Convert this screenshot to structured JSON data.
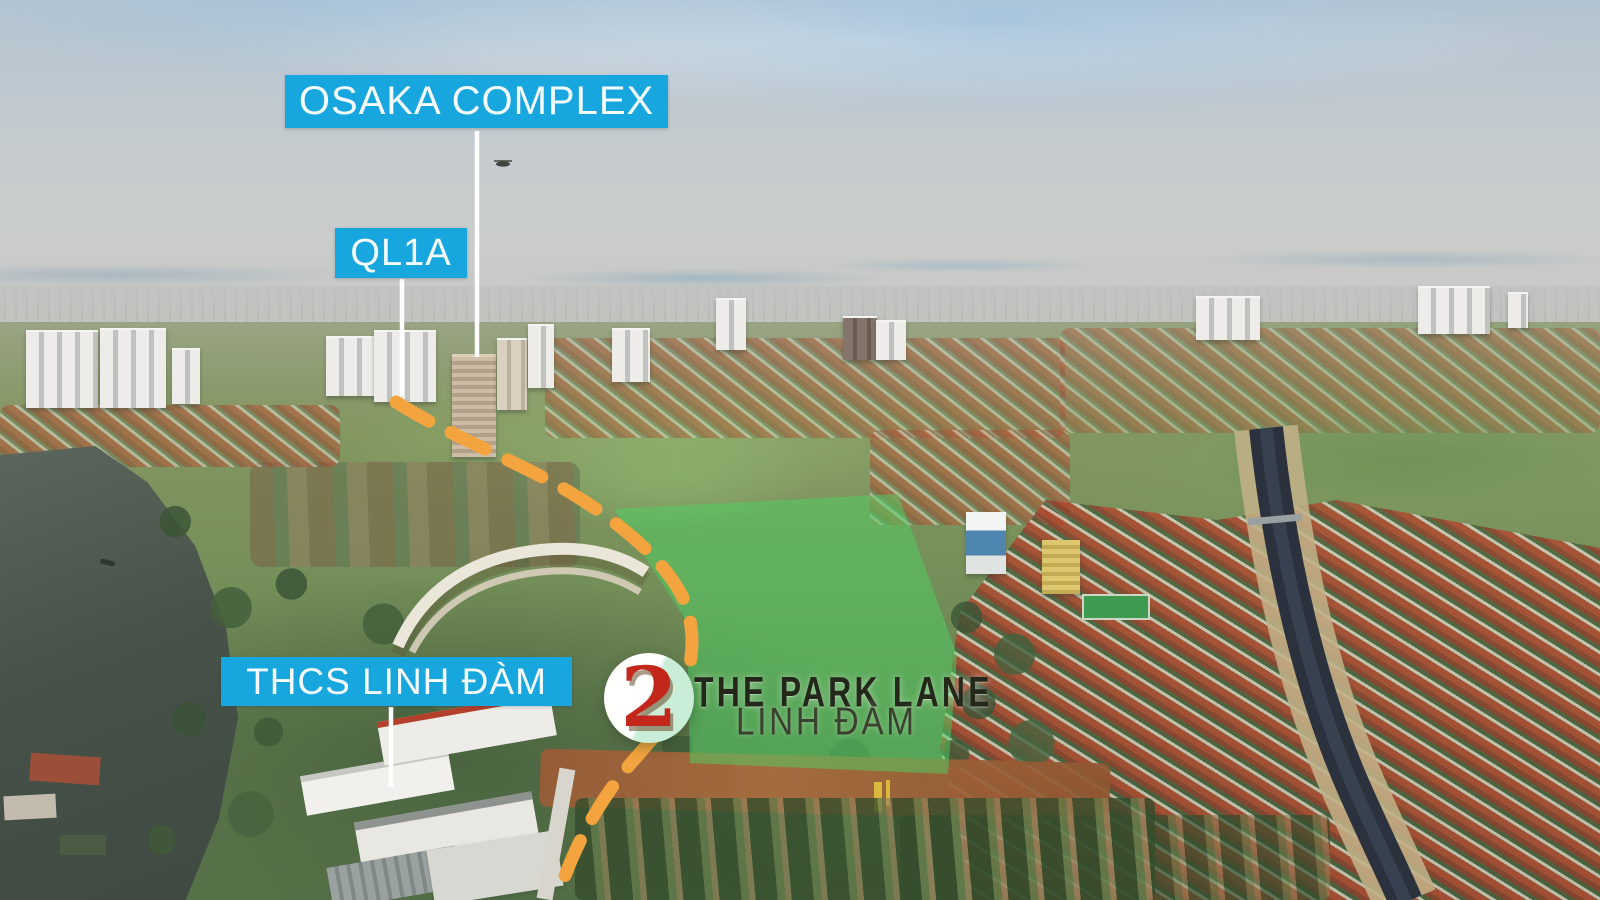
{
  "labels": {
    "osaka_complex": "OSAKA COMPLEX",
    "ql1a": "QL1A",
    "thcs_linh_dam": "THCS LINH ĐÀM"
  },
  "project": {
    "marker_number": "2",
    "name": "THE PARK LANE",
    "location": "LINH ĐÀM"
  },
  "colors": {
    "label_bg": "#18a6de",
    "label_text": "#f4fcff",
    "route_dash": "#f3a43e",
    "site_overlay": "#4ed164",
    "marker_number": "#c3271b",
    "marker_mint": "#c9edd6",
    "project_name_color": "#23281b",
    "project_location_color": "#3a422f"
  }
}
